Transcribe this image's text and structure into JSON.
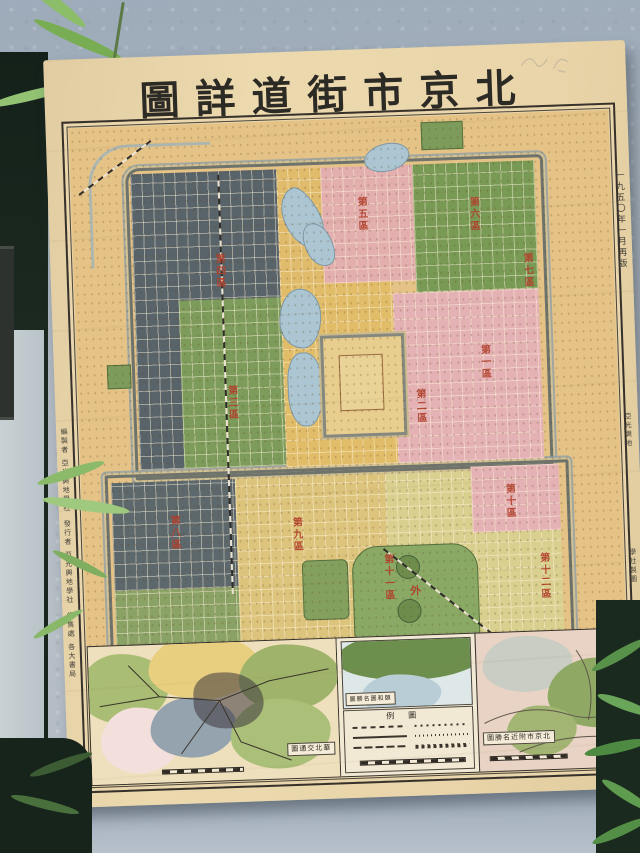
{
  "scene": {
    "wall_color": "#b2bac2",
    "floor_color": "#b7c0cb",
    "bamboo_color": "#6fa352"
  },
  "poster": {
    "title": "北京市街道詳圖",
    "title_display": "圖詳道街市京北",
    "edition_note": "一九五〇年一月再版",
    "publisher_small_1": "亞光輿地",
    "publisher_small_2": "學社製圖",
    "colophon_1": "編製者 亞光輿地學社",
    "colophon_2": "發行者 亞光輿地學社",
    "colophon_3": "經售處 各大書局"
  },
  "main_map": {
    "labels": {
      "d1": "第一區",
      "d2": "第二區",
      "d3": "第三區",
      "d4": "第四區",
      "d5": "第五區",
      "d6": "第六區",
      "d7": "第七區",
      "d8": "第八區",
      "d9": "第九區",
      "d10": "第十區",
      "d11": "第十一區",
      "d12": "第十二區",
      "outer": "外"
    }
  },
  "insets": {
    "left_caption": "華北交通圖",
    "left_caption_display": "圖通交北華",
    "middle_caption": "頤和園名勝圖",
    "middle_caption_display": "圖勝名園和頤",
    "legend_title": "圖例",
    "legend_title_display": "例圖",
    "right_caption": "北京市附近名勝圖",
    "right_caption_display": "圖勝名近附市京北"
  }
}
